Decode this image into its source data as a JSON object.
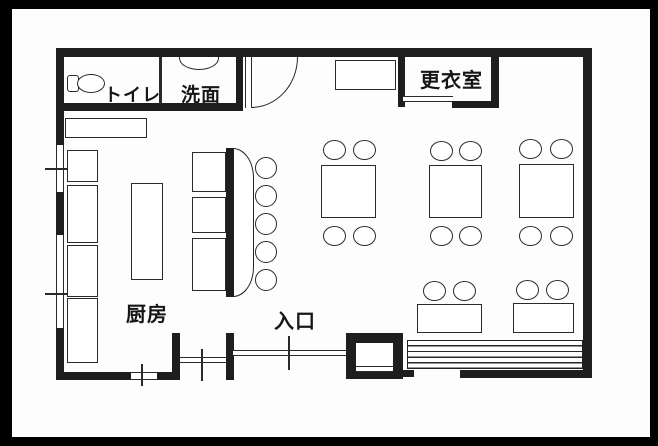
{
  "labels": {
    "toilet": "トイレ",
    "washroom": "洗面",
    "changing_room": "更衣室",
    "kitchen": "厨房",
    "entrance": "入口"
  },
  "furniture": {
    "counter_stools": 5,
    "square_tables_4_seat": 3,
    "low_tables_2_seat": 2,
    "chairs_total": 16,
    "bench_seats": 1,
    "kitchen_units_left_wall": 4,
    "kitchen_units_counter_side": 3,
    "kitchen_island": 1
  },
  "colors": {
    "frame": "#000000",
    "wall": "#1e1e1e",
    "line": "#2a2a2a",
    "floor": "#ffffff"
  }
}
